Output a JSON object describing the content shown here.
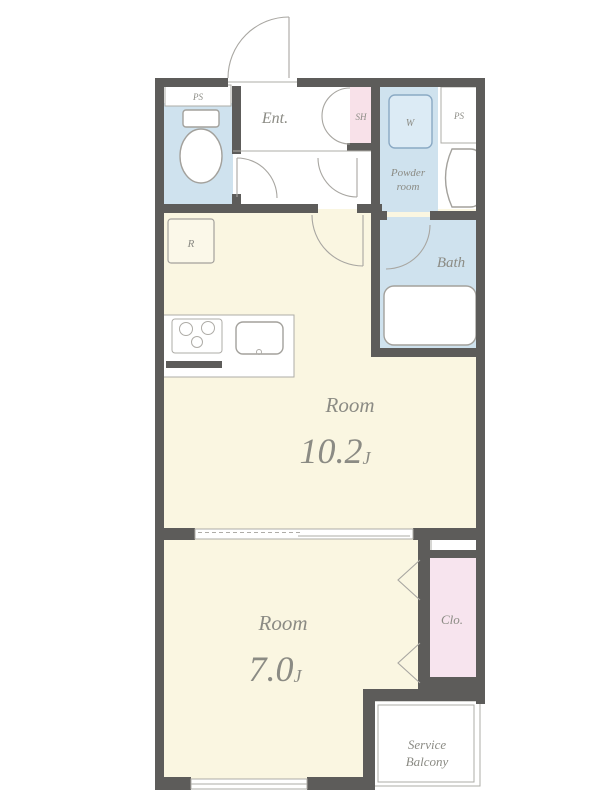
{
  "floorplan": {
    "rooms": {
      "entrance": {
        "label": "Ent."
      },
      "toilet": {
        "ps_label": "PS"
      },
      "shoe_box": {
        "label": "SH"
      },
      "powder_room": {
        "line1": "Powder",
        "line2": "room",
        "washer_label": "W",
        "ps_label": "PS"
      },
      "bath": {
        "label": "Bath"
      },
      "living": {
        "name": "Room",
        "size": "10.2",
        "size_unit": "J",
        "fridge_label": "R"
      },
      "bedroom": {
        "name": "Room",
        "size": "7.0",
        "size_unit": "J"
      },
      "closet": {
        "label": "Clo."
      },
      "service_balcony": {
        "line1": "Service",
        "line2": "Balcony"
      }
    },
    "colors": {
      "wall": "#5d5c5a",
      "room_cream": "#faf6e1",
      "wet_blue": "#cfe2ee",
      "pink": "#f8e1e9",
      "closet_pink": "#f7e4ee",
      "washer_fill": "#dcebf5",
      "washer_stroke": "#8aa9c4",
      "label_text": "#8b8b84",
      "fixture_stroke": "#a3a19c",
      "thin_stroke": "#aeaca7",
      "door_stroke": "#a8a6a1"
    }
  }
}
